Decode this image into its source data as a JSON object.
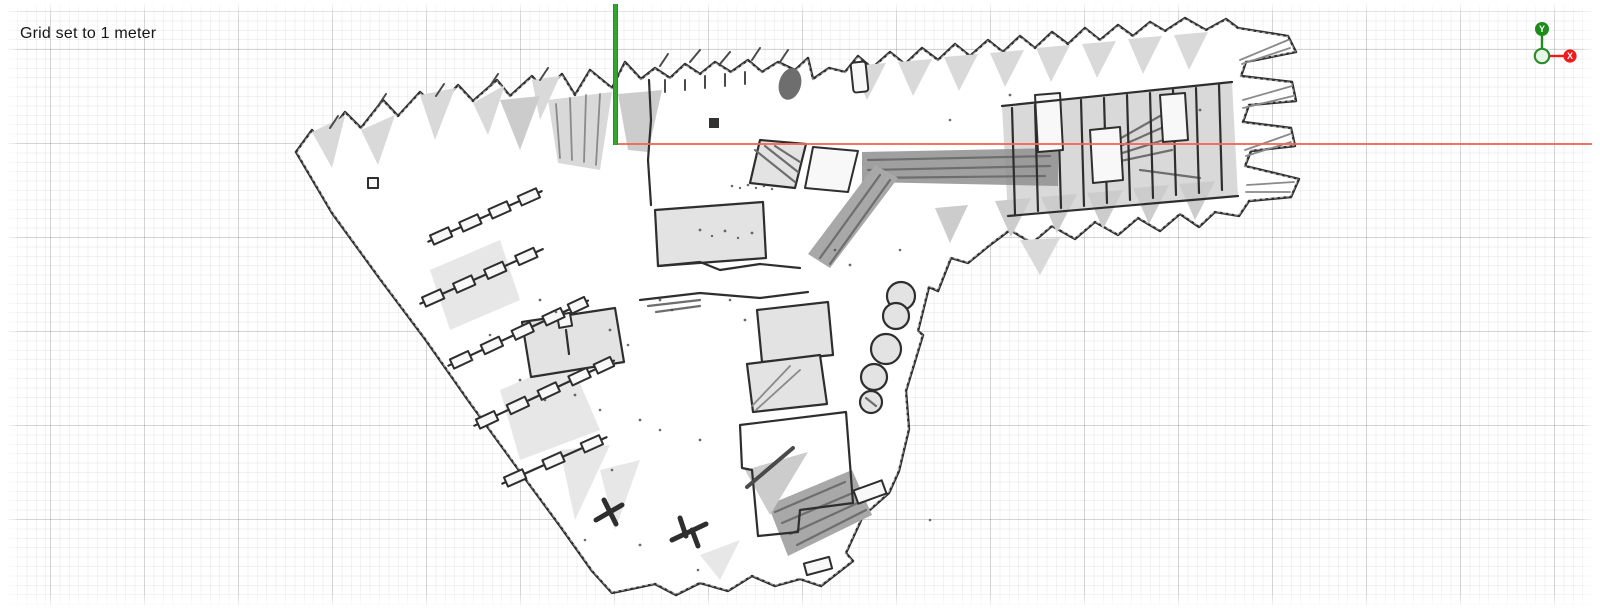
{
  "hud": {
    "grid_label": "Grid set to 1 meter"
  },
  "grid": {
    "unit": "1 meter",
    "minor_step_px": 9.4,
    "major_step_px": 94,
    "minor_color": "#ececec",
    "major_color": "#d7d7d7",
    "background_color": "#ffffff"
  },
  "axes": {
    "x": {
      "label": "X",
      "color": "#ee1b1b",
      "line_color": "#f0685c"
    },
    "y": {
      "label": "Y",
      "color": "#1d8c1d",
      "line_color": "#2f9c23"
    },
    "origin": {
      "fill": "#e8f6e8",
      "stroke": "#2c8c2c"
    }
  },
  "map": {
    "kind": "occupancy-grid-map",
    "wall_color": "#2e2e2e",
    "free_color": "#ffffff",
    "shade_color": "#d9d9d9",
    "unknown_color": "transparent"
  }
}
